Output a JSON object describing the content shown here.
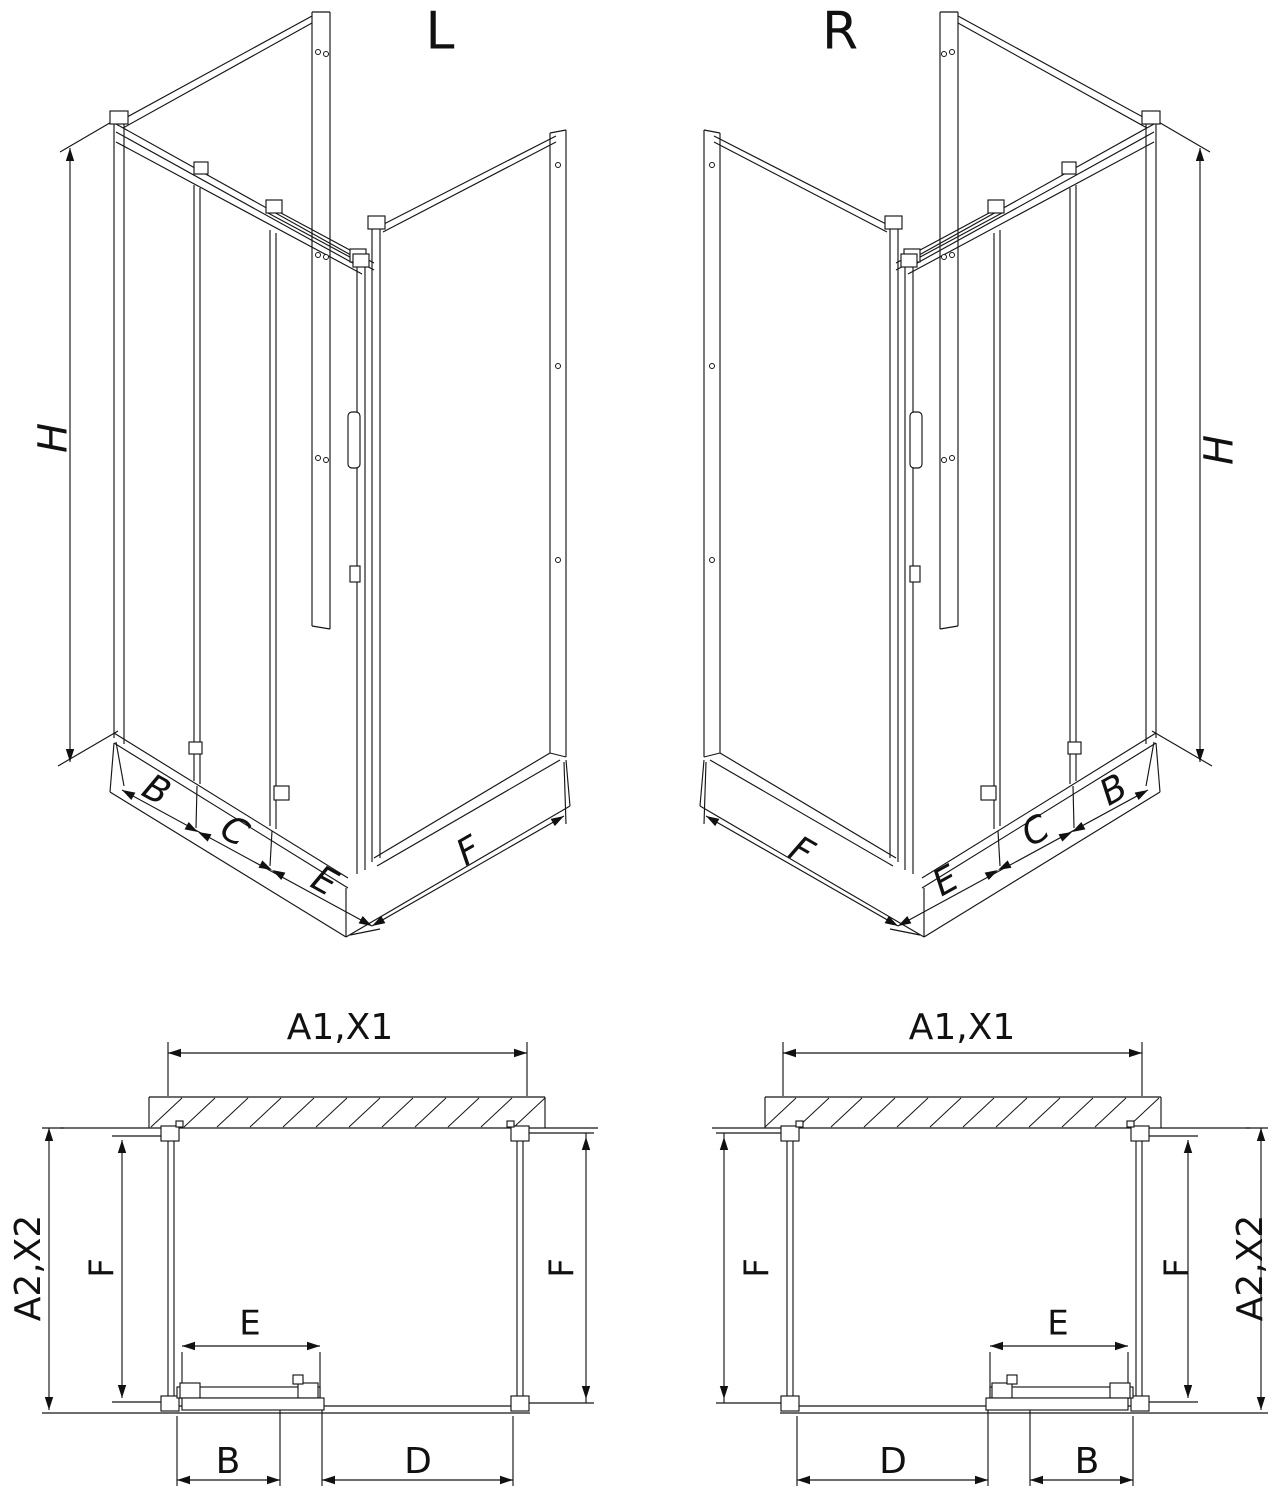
{
  "background": "#ffffff",
  "line_color": "#161616",
  "iso_views": {
    "left": {
      "variant_label": "L",
      "height_label": "H",
      "front_segment_labels": [
        "B",
        "C",
        "E"
      ],
      "side_depth_label": "F"
    },
    "right": {
      "variant_label": "R",
      "height_label": "H",
      "front_segment_labels": [
        "B",
        "C",
        "E"
      ],
      "side_depth_label": "F"
    }
  },
  "plan_views": {
    "left": {
      "overall_width_label": "A1,X1",
      "overall_depth_label": "A2,X2",
      "side_wall_labels": [
        "F",
        "F"
      ],
      "door_opening_label": "E",
      "door_width_label": "B",
      "fixed_width_label": "D"
    },
    "right": {
      "overall_width_label": "A1,X1",
      "overall_depth_label": "A2,X2",
      "side_wall_labels": [
        "F",
        "F"
      ],
      "door_opening_label": "E",
      "door_width_label": "B",
      "fixed_width_label": "D"
    }
  }
}
